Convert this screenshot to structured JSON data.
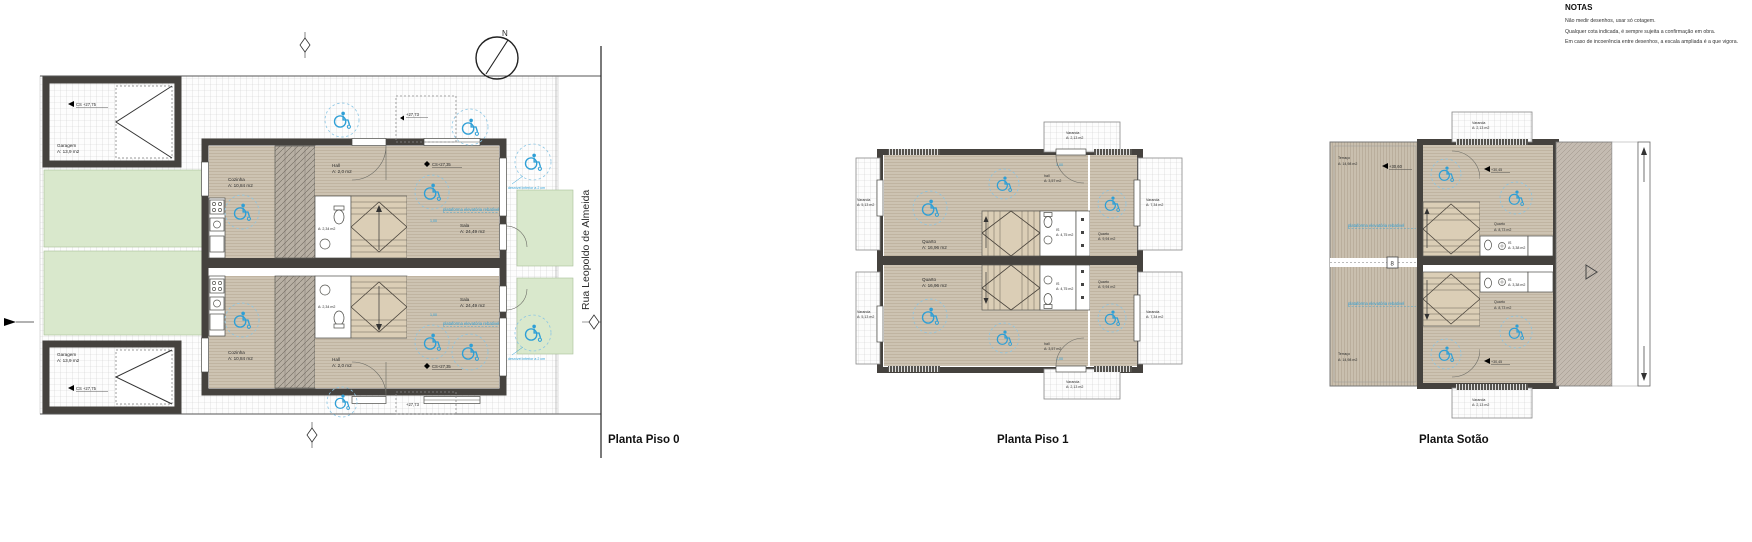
{
  "notes": {
    "title": "NOTAS",
    "lines": [
      "Não medir desenhos, usar só cotagem.",
      "Qualquer cota indicada, é sempre sujeita a confirmação em obra.",
      "Em caso de incoerência entre desenhos, a escala ampliada é a que vigora."
    ]
  },
  "titles": {
    "piso0": "Planta Piso 0",
    "piso1": "Planta Piso 1",
    "sotao": "Planta Sotão"
  },
  "street": {
    "name": "Rua Leopoldo de Almeida"
  },
  "compass": {
    "north": "N"
  },
  "annotations": {
    "platform": "plataforma elevatória rebatível",
    "step_note": "desnível inferior a 2 cm",
    "dim_100": "1,00"
  },
  "piso0": {
    "garagem": {
      "name": "Garagem",
      "area": "A: 13,9 m2"
    },
    "cozinha": {
      "name": "Cozinha",
      "area": "A: 10,84 m2"
    },
    "hall": {
      "name": "Hall",
      "area": "A: 2,0 m2"
    },
    "sala": {
      "name": "Sala",
      "area": "A: 24,49 m2"
    },
    "is": {
      "area": "A: 2,34 m2"
    },
    "levels": {
      "garagem": "CS +27,75",
      "sala": "CS+27,35",
      "entrada": "+27,73"
    }
  },
  "piso1": {
    "quarto_left": {
      "name": "Quarto",
      "area": "A: 16,96 m2"
    },
    "quarto_right": {
      "name": "Quarto",
      "area": "A: 9,94 m2"
    },
    "hall": {
      "name": "hall",
      "area": "A: 3,57 m2"
    },
    "is": {
      "name": "IS",
      "area": "A: 4,75 m2"
    },
    "varanda_left": {
      "name": "Varanda",
      "area": "A: 5,13 m2"
    },
    "varanda_right": {
      "name": "Varanda",
      "area": "A: 7,34 m2"
    },
    "varanda_entry": {
      "name": "Varanda",
      "area": "A: 2,13 m2"
    }
  },
  "sotao": {
    "terraco": {
      "name": "Terraço",
      "area": "A: 14,98 m2"
    },
    "quarto": {
      "name": "Quarto",
      "area": "A: 8,73 m2"
    },
    "is": {
      "name": "IS",
      "area": "A: 3,38 m2"
    },
    "varanda": {
      "name": "Varanda",
      "area": "A: 2,13 m2"
    },
    "levels": {
      "terraco": "+30,60",
      "quarto": "+30,45"
    },
    "divider_mark": "8"
  },
  "colors": {
    "annotation_blue": "#2E9FD6",
    "wall": "#45423E",
    "green_area": "#D9E8CC",
    "wood_floor": "#CDC3B2"
  }
}
